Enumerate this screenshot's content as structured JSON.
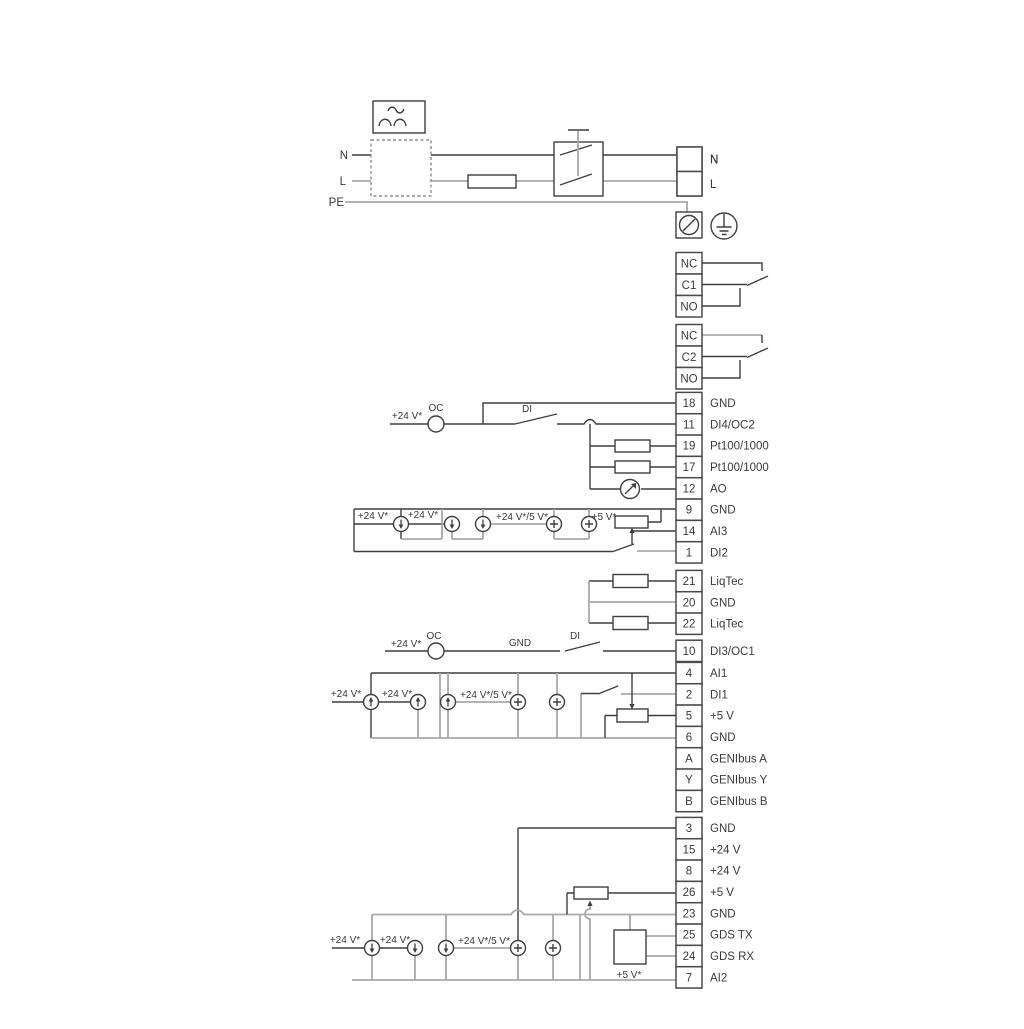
{
  "power": {
    "left_labels": [
      {
        "text": "N",
        "x": 348,
        "y": 159
      },
      {
        "text": "L",
        "x": 346,
        "y": 185
      },
      {
        "text": "PE",
        "x": 344,
        "y": 206
      }
    ],
    "right_labels": [
      {
        "text": "N",
        "x": 710,
        "y": 163
      },
      {
        "text": "L",
        "x": 710,
        "y": 188
      }
    ]
  },
  "terminal_strips": [
    {
      "id": "relay1",
      "x": 676,
      "w": 26,
      "row_h": 21.5,
      "top": 252.5,
      "rows": [
        {
          "cell": "NC",
          "label": ""
        },
        {
          "cell": "C1",
          "label": ""
        },
        {
          "cell": "NO",
          "label": ""
        }
      ]
    },
    {
      "id": "relay2",
      "x": 676,
      "w": 26,
      "row_h": 21.5,
      "top": 324.5,
      "rows": [
        {
          "cell": "NC",
          "label": ""
        },
        {
          "cell": "C2",
          "label": ""
        },
        {
          "cell": "NO",
          "label": ""
        }
      ]
    },
    {
      "id": "groupA",
      "x": 676,
      "w": 26,
      "row_h": 21.33,
      "top": 392.4,
      "rows": [
        {
          "cell": "18",
          "label": "GND"
        },
        {
          "cell": "11",
          "label": "DI4/OC2"
        },
        {
          "cell": "19",
          "label": "Pt100/1000"
        },
        {
          "cell": "17",
          "label": "Pt100/1000"
        },
        {
          "cell": "12",
          "label": "AO"
        },
        {
          "cell": "9",
          "label": "GND"
        },
        {
          "cell": "14",
          "label": "AI3"
        },
        {
          "cell": "1",
          "label": "DI2"
        }
      ]
    },
    {
      "id": "groupB",
      "x": 676,
      "w": 26,
      "row_h": 21.33,
      "top": 570.4,
      "rows": [
        {
          "cell": "21",
          "label": "LiqTec"
        },
        {
          "cell": "20",
          "label": "GND"
        },
        {
          "cell": "22",
          "label": "LiqTec"
        }
      ]
    },
    {
      "id": "groupC",
      "x": 676,
      "w": 26,
      "row_h": 21.33,
      "top": 640.2,
      "rows": [
        {
          "cell": "10",
          "label": "DI3/OC1"
        }
      ]
    },
    {
      "id": "groupD",
      "x": 676,
      "w": 26,
      "row_h": 21.33,
      "top": 662.4,
      "rows": [
        {
          "cell": "4",
          "label": "AI1"
        },
        {
          "cell": "2",
          "label": "DI1"
        },
        {
          "cell": "5",
          "label": "+5 V"
        },
        {
          "cell": "6",
          "label": "GND"
        },
        {
          "cell": "A",
          "label": "GENIbus A"
        },
        {
          "cell": "Y",
          "label": "GENIbus Y"
        },
        {
          "cell": "B",
          "label": "GENIbus B"
        }
      ]
    },
    {
      "id": "groupE",
      "x": 676,
      "w": 26,
      "row_h": 21.33,
      "top": 817.4,
      "rows": [
        {
          "cell": "3",
          "label": "GND"
        },
        {
          "cell": "15",
          "label": "+24 V"
        },
        {
          "cell": "8",
          "label": "+24 V"
        },
        {
          "cell": "26",
          "label": "+5 V"
        },
        {
          "cell": "23",
          "label": "GND"
        },
        {
          "cell": "25",
          "label": "GDS TX"
        },
        {
          "cell": "24",
          "label": "GDS RX"
        },
        {
          "cell": "7",
          "label": "AI2"
        }
      ]
    },
    {
      "id": "mains",
      "x": 677,
      "w": 25,
      "row_h": 24.5,
      "top": 147,
      "rows": [
        {
          "cell": "",
          "label": "N"
        },
        {
          "cell": "",
          "label": "L"
        }
      ]
    }
  ],
  "label_x": 710,
  "wire_labels": [
    {
      "text": "+24 V*",
      "x": 407,
      "y": 419
    },
    {
      "text": "OC",
      "x": 436,
      "y": 411
    },
    {
      "text": "DI",
      "x": 527,
      "y": 412
    },
    {
      "text": "+24 V*",
      "x": 373,
      "y": 519
    },
    {
      "text": "+24 V*",
      "x": 423,
      "y": 518
    },
    {
      "text": "+24 V*/5 V*",
      "x": 522,
      "y": 520
    },
    {
      "text": "+5 V*",
      "x": 604,
      "y": 520
    },
    {
      "text": "+24 V*",
      "x": 406,
      "y": 647
    },
    {
      "text": "OC",
      "x": 434,
      "y": 639
    },
    {
      "text": "GND",
      "x": 520,
      "y": 646
    },
    {
      "text": "DI",
      "x": 575,
      "y": 639
    },
    {
      "text": "+24 V*",
      "x": 346,
      "y": 697
    },
    {
      "text": "+24 V*",
      "x": 397,
      "y": 697
    },
    {
      "text": "+24 V*/5 V*",
      "x": 486,
      "y": 698
    },
    {
      "text": "+24 V*",
      "x": 345,
      "y": 943
    },
    {
      "text": "+24 V*",
      "x": 395,
      "y": 943
    },
    {
      "text": "+24 V*/5 V*",
      "x": 484,
      "y": 944
    },
    {
      "text": "+5 V*",
      "x": 629,
      "y": 978
    }
  ],
  "current_sources": [
    {
      "x": 401,
      "y": 524,
      "t": "down"
    },
    {
      "x": 452,
      "y": 524,
      "t": "down"
    },
    {
      "x": 483,
      "y": 524,
      "t": "down"
    },
    {
      "x": 554,
      "y": 524,
      "t": "plus"
    },
    {
      "x": 589,
      "y": 524,
      "t": "plus"
    },
    {
      "x": 371,
      "y": 702,
      "t": "up"
    },
    {
      "x": 418,
      "y": 702,
      "t": "up"
    },
    {
      "x": 448,
      "y": 702,
      "t": "up"
    },
    {
      "x": 518,
      "y": 702,
      "t": "plus"
    },
    {
      "x": 557,
      "y": 702,
      "t": "plus"
    },
    {
      "x": 372,
      "y": 948,
      "t": "down"
    },
    {
      "x": 415,
      "y": 948,
      "t": "down"
    },
    {
      "x": 446,
      "y": 948,
      "t": "down"
    },
    {
      "x": 518,
      "y": 948,
      "t": "plus"
    },
    {
      "x": 553,
      "y": 948,
      "t": "plus"
    }
  ],
  "oc_circles": [
    {
      "x": 436,
      "y": 424
    },
    {
      "x": 436,
      "y": 651
    }
  ],
  "meter": {
    "x": 630,
    "y": 489
  },
  "resistors": [
    {
      "x": 615,
      "y": 440,
      "w": 35,
      "h": 12
    },
    {
      "x": 615,
      "y": 461,
      "w": 35,
      "h": 12
    },
    {
      "x": 613,
      "y": 574.5,
      "w": 35,
      "h": 13
    },
    {
      "x": 613,
      "y": 616.5,
      "w": 35,
      "h": 13
    }
  ],
  "potentiometers": [
    {
      "x": 615,
      "y": 516,
      "w": 33,
      "h": 12
    },
    {
      "x": 617,
      "y": 709,
      "w": 31,
      "h": 13
    },
    {
      "x": 574,
      "y": 887,
      "w": 34,
      "h": 12
    }
  ],
  "gds_box": {
    "x": 614,
    "y": 930,
    "w": 32,
    "h": 34
  },
  "colors": {
    "dark": "#3f3f3f",
    "gray": "#a9a9a9",
    "box_border": "#4a4a4a"
  }
}
